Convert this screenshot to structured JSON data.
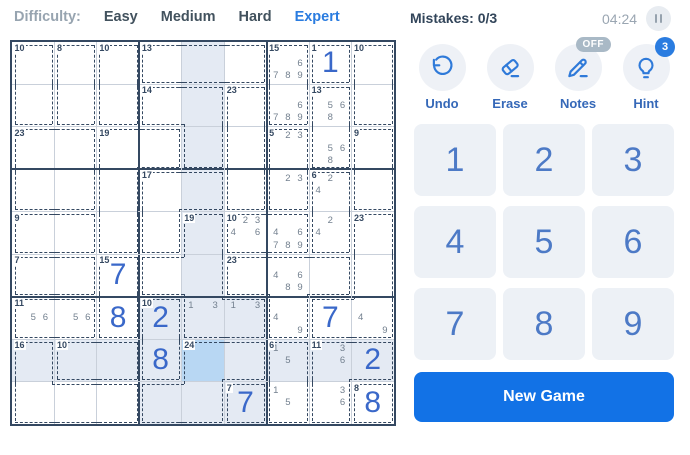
{
  "header": {
    "difficulty_label": "Difficulty:",
    "levels": [
      {
        "label": "Easy",
        "active": false
      },
      {
        "label": "Medium",
        "active": false
      },
      {
        "label": "Hard",
        "active": false
      },
      {
        "label": "Expert",
        "active": true
      }
    ],
    "mistakes": "Mistakes: 0/3",
    "timer": "04:24",
    "pause_icon": "pause-icon"
  },
  "toolbar": {
    "buttons": [
      {
        "id": "undo",
        "label": "Undo",
        "icon": "undo-icon"
      },
      {
        "id": "erase",
        "label": "Erase",
        "icon": "eraser-icon"
      },
      {
        "id": "notes",
        "label": "Notes",
        "icon": "pencil-icon",
        "badge": "OFF"
      },
      {
        "id": "hint",
        "label": "Hint",
        "icon": "lightbulb-icon",
        "badge": "3"
      }
    ]
  },
  "numpad": {
    "digits": [
      "1",
      "2",
      "3",
      "4",
      "5",
      "6",
      "7",
      "8",
      "9"
    ]
  },
  "new_game": {
    "label": "New Game"
  },
  "board": {
    "rows": 9,
    "cols": 9,
    "selected": {
      "row": 8,
      "col": 5
    },
    "highlight": {
      "row": 8,
      "col": 5,
      "block_rows": [
        7,
        9
      ],
      "block_cols": [
        4,
        6
      ]
    },
    "cages": [
      {
        "sum": 10,
        "cells": [
          [
            1,
            1
          ],
          [
            2,
            1
          ]
        ]
      },
      {
        "sum": 8,
        "cells": [
          [
            1,
            2
          ],
          [
            2,
            2
          ]
        ]
      },
      {
        "sum": 10,
        "cells": [
          [
            1,
            3
          ],
          [
            2,
            3
          ]
        ]
      },
      {
        "sum": 13,
        "cells": [
          [
            1,
            4
          ],
          [
            1,
            5
          ],
          [
            1,
            6
          ]
        ]
      },
      {
        "sum": 15,
        "cells": [
          [
            1,
            7
          ],
          [
            2,
            7
          ]
        ]
      },
      {
        "sum": 1,
        "cells": [
          [
            1,
            8
          ]
        ]
      },
      {
        "sum": 10,
        "cells": [
          [
            1,
            9
          ],
          [
            2,
            9
          ]
        ]
      },
      {
        "sum": 14,
        "cells": [
          [
            2,
            4
          ],
          [
            2,
            5
          ],
          [
            3,
            5
          ]
        ]
      },
      {
        "sum": 23,
        "cells": [
          [
            2,
            6
          ],
          [
            3,
            6
          ],
          [
            4,
            6
          ]
        ]
      },
      {
        "sum": 13,
        "cells": [
          [
            2,
            8
          ],
          [
            3,
            8
          ]
        ]
      },
      {
        "sum": 23,
        "cells": [
          [
            3,
            1
          ],
          [
            3,
            2
          ],
          [
            4,
            1
          ],
          [
            4,
            2
          ]
        ]
      },
      {
        "sum": 19,
        "cells": [
          [
            3,
            3
          ],
          [
            3,
            4
          ],
          [
            4,
            3
          ],
          [
            5,
            3
          ]
        ]
      },
      {
        "sum": 5,
        "cells": [
          [
            3,
            7
          ],
          [
            4,
            7
          ]
        ]
      },
      {
        "sum": 9,
        "cells": [
          [
            3,
            9
          ],
          [
            4,
            9
          ]
        ]
      },
      {
        "sum": 17,
        "cells": [
          [
            4,
            4
          ],
          [
            4,
            5
          ],
          [
            5,
            4
          ]
        ]
      },
      {
        "sum": 6,
        "cells": [
          [
            4,
            8
          ],
          [
            5,
            8
          ]
        ]
      },
      {
        "sum": 9,
        "cells": [
          [
            5,
            1
          ],
          [
            5,
            2
          ]
        ]
      },
      {
        "sum": 19,
        "cells": [
          [
            5,
            5
          ],
          [
            6,
            4
          ],
          [
            6,
            5
          ],
          [
            7,
            5
          ],
          [
            7,
            6
          ]
        ]
      },
      {
        "sum": 10,
        "cells": [
          [
            5,
            6
          ],
          [
            5,
            7
          ]
        ]
      },
      {
        "sum": 23,
        "cells": [
          [
            5,
            9
          ],
          [
            6,
            9
          ],
          [
            7,
            8
          ],
          [
            7,
            9
          ]
        ]
      },
      {
        "sum": 7,
        "cells": [
          [
            6,
            1
          ],
          [
            6,
            2
          ]
        ]
      },
      {
        "sum": 15,
        "cells": [
          [
            6,
            3
          ],
          [
            7,
            3
          ]
        ]
      },
      {
        "sum": 23,
        "cells": [
          [
            6,
            6
          ],
          [
            6,
            7
          ],
          [
            6,
            8
          ],
          [
            7,
            7
          ]
        ]
      },
      {
        "sum": 11,
        "cells": [
          [
            7,
            1
          ],
          [
            7,
            2
          ]
        ]
      },
      {
        "sum": 10,
        "cells": [
          [
            7,
            4
          ],
          [
            8,
            4
          ]
        ]
      },
      {
        "sum": 16,
        "cells": [
          [
            8,
            1
          ],
          [
            9,
            1
          ],
          [
            9,
            2
          ],
          [
            9,
            3
          ]
        ]
      },
      {
        "sum": 10,
        "cells": [
          [
            8,
            2
          ],
          [
            8,
            3
          ]
        ]
      },
      {
        "sum": 24,
        "cells": [
          [
            8,
            5
          ],
          [
            8,
            6
          ],
          [
            9,
            4
          ],
          [
            9,
            5
          ]
        ]
      },
      {
        "sum": 6,
        "cells": [
          [
            8,
            7
          ],
          [
            9,
            7
          ]
        ]
      },
      {
        "sum": 11,
        "cells": [
          [
            8,
            8
          ],
          [
            8,
            9
          ],
          [
            9,
            8
          ]
        ]
      },
      {
        "sum": 7,
        "cells": [
          [
            9,
            6
          ]
        ]
      },
      {
        "sum": 8,
        "cells": [
          [
            9,
            9
          ]
        ]
      }
    ],
    "entries": [
      {
        "row": 1,
        "col": 8,
        "value": "1"
      },
      {
        "row": 6,
        "col": 3,
        "value": "7"
      },
      {
        "row": 7,
        "col": 3,
        "value": "8"
      },
      {
        "row": 7,
        "col": 4,
        "value": "2"
      },
      {
        "row": 7,
        "col": 8,
        "value": "7"
      },
      {
        "row": 8,
        "col": 4,
        "value": "8"
      },
      {
        "row": 8,
        "col": 9,
        "value": "2"
      },
      {
        "row": 9,
        "col": 6,
        "value": "7"
      },
      {
        "row": 9,
        "col": 9,
        "value": "8"
      }
    ],
    "notes": [
      {
        "row": 1,
        "col": 7,
        "digits": [
          6,
          7,
          8,
          9
        ]
      },
      {
        "row": 2,
        "col": 7,
        "digits": [
          6,
          7,
          8,
          9
        ]
      },
      {
        "row": 2,
        "col": 8,
        "digits": [
          5,
          6,
          8
        ]
      },
      {
        "row": 3,
        "col": 7,
        "digits": [
          2,
          3
        ]
      },
      {
        "row": 3,
        "col": 8,
        "digits": [
          5,
          6,
          8
        ]
      },
      {
        "row": 4,
        "col": 7,
        "digits": [
          2,
          3
        ]
      },
      {
        "row": 4,
        "col": 8,
        "digits": [
          2,
          4
        ]
      },
      {
        "row": 5,
        "col": 6,
        "digits": [
          1,
          2,
          3,
          4,
          6
        ]
      },
      {
        "row": 5,
        "col": 7,
        "digits": [
          4,
          6,
          7,
          8,
          9
        ]
      },
      {
        "row": 5,
        "col": 8,
        "digits": [
          2,
          4
        ]
      },
      {
        "row": 6,
        "col": 7,
        "digits": [
          4,
          6,
          8,
          9
        ]
      },
      {
        "row": 7,
        "col": 1,
        "digits": [
          5,
          6
        ]
      },
      {
        "row": 7,
        "col": 2,
        "digits": [
          5,
          6
        ]
      },
      {
        "row": 7,
        "col": 5,
        "digits": [
          1,
          3
        ]
      },
      {
        "row": 7,
        "col": 6,
        "digits": [
          1,
          3
        ]
      },
      {
        "row": 7,
        "col": 7,
        "digits": [
          4,
          9
        ]
      },
      {
        "row": 7,
        "col": 9,
        "digits": [
          4,
          9
        ]
      },
      {
        "row": 8,
        "col": 7,
        "digits": [
          1,
          5
        ]
      },
      {
        "row": 8,
        "col": 8,
        "digits": [
          3,
          6
        ]
      },
      {
        "row": 9,
        "col": 7,
        "digits": [
          1,
          5
        ]
      },
      {
        "row": 9,
        "col": 8,
        "digits": [
          3,
          6
        ]
      }
    ]
  },
  "colors": {
    "accent": "#2a7ce0",
    "entry_digit": "#3a68c9",
    "note_digit": "#73808f",
    "cage_line": "#344861",
    "selected_cell_bg": "#b8d7f3",
    "highlight_area_bg": "#e4eaf3",
    "thin_grid_line": "#c9d0da",
    "numpad_bg": "#edf1f6",
    "new_game_bg": "#1272e6",
    "badge_off_bg": "#a9b9c6",
    "badge_count_bg": "#2a7ce0"
  }
}
